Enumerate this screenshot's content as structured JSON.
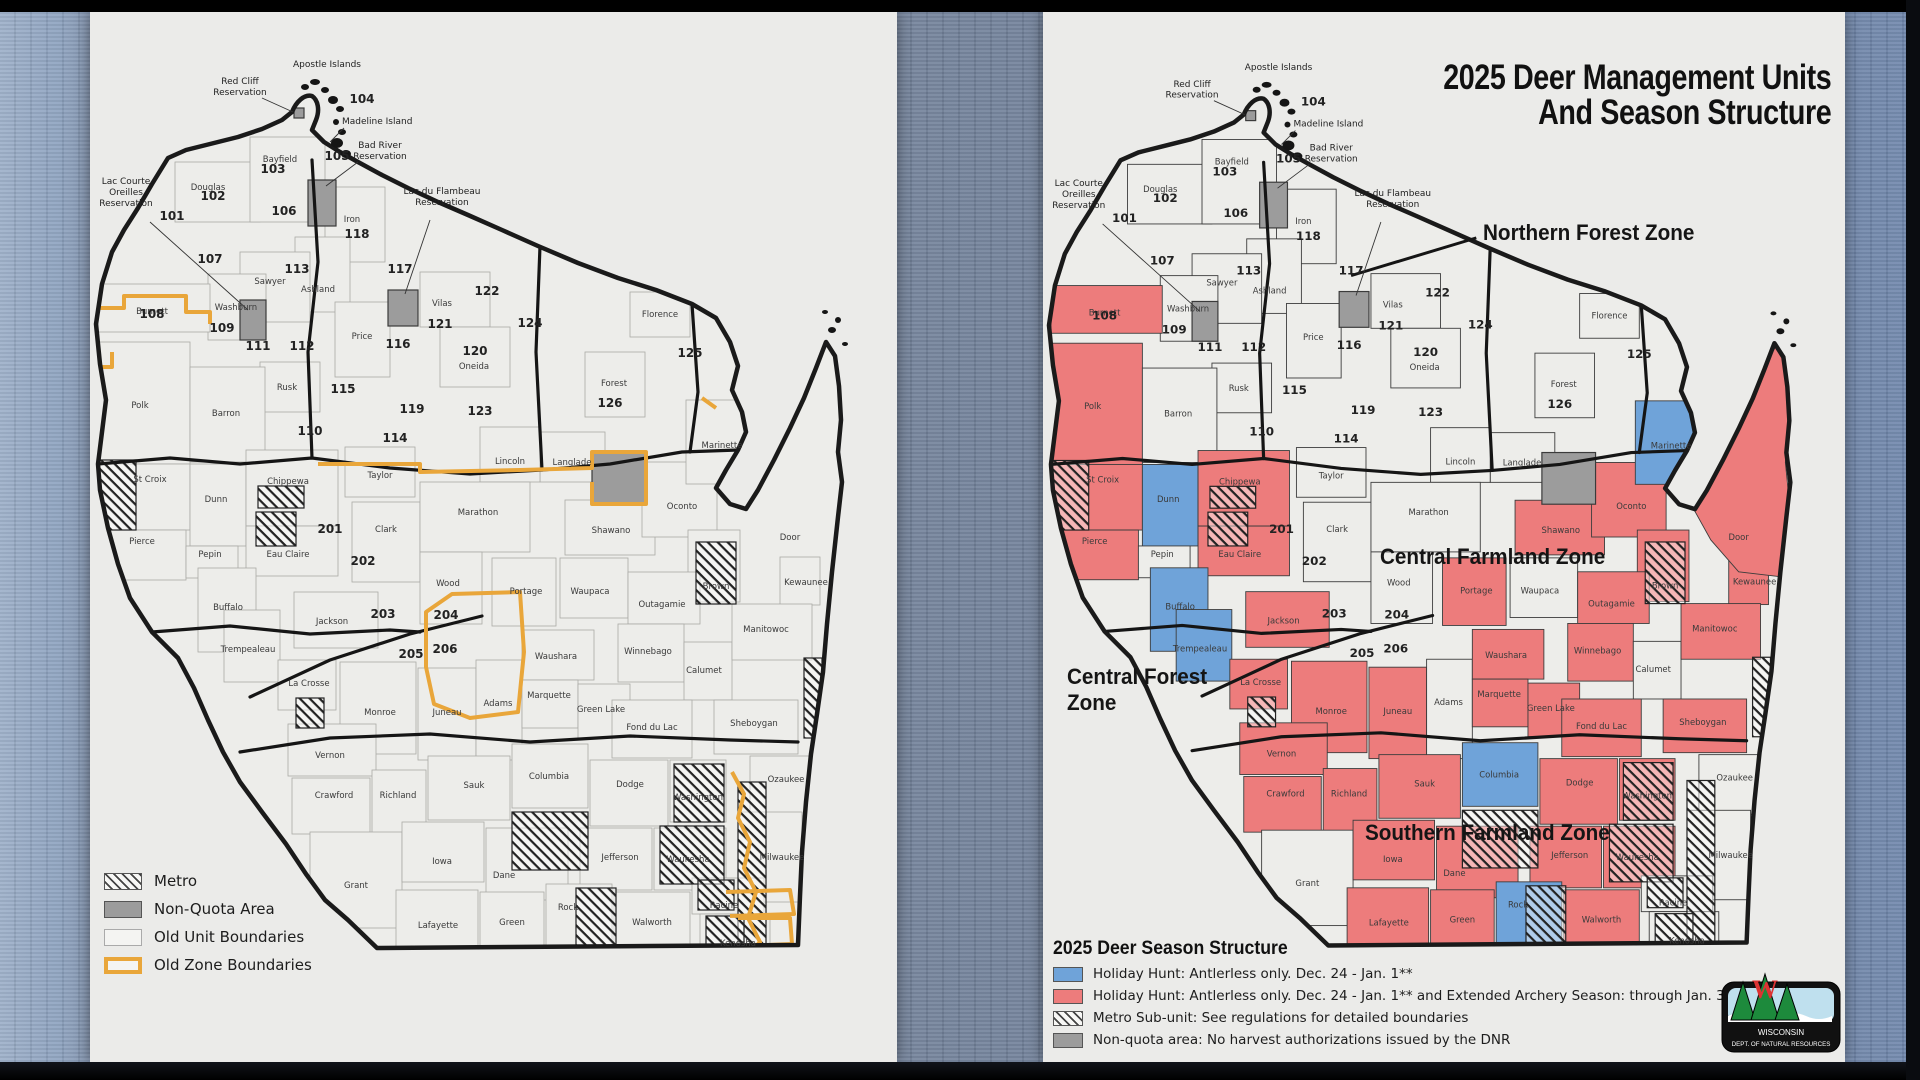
{
  "left_panel": {
    "legend": {
      "items": [
        {
          "swatch": "hatch",
          "label": "Metro"
        },
        {
          "swatch": "gray",
          "label": "Non-Quota Area"
        },
        {
          "swatch": "white",
          "label": "Old Unit Boundaries"
        },
        {
          "swatch": "orange",
          "label": "Old Zone Boundaries"
        }
      ]
    }
  },
  "right_panel": {
    "title_line1": "2025 Deer Management Units",
    "title_line2": "And Season Structure",
    "zone_labels": {
      "northern": "Northern Forest Zone",
      "central_farmland": "Central Farmland Zone",
      "central_forest_1": "Central Forest",
      "central_forest_2": "Zone",
      "southern": "Southern Farmland Zone"
    },
    "legend": {
      "title": "2025 Deer Season Structure",
      "items": [
        {
          "swatch": "blue",
          "label": "Holiday Hunt: Antlerless only. Dec. 24 - Jan. 1**"
        },
        {
          "swatch": "red",
          "label": "Holiday Hunt: Antlerless only. Dec. 24 - Jan. 1** and Extended Archery Season: through Jan. 31, 2026"
        },
        {
          "swatch": "hatch",
          "label": "Metro Sub-unit: See regulations for detailed boundaries"
        },
        {
          "swatch": "gray",
          "label": "Non-quota area: No harvest authorizations issued by the DNR"
        }
      ]
    },
    "logo": {
      "line1": "WISCONSIN",
      "line2": "DEPT. OF NATURAL RESOURCES"
    }
  },
  "map": {
    "colors": {
      "red": "#ed7c7c",
      "blue": "#6fa3d9",
      "gray": "#9c9c9c",
      "paper": "#ededea",
      "orange": "#e9a63a",
      "outline": "#1a1a1a"
    },
    "state_path": "M 78,146 L 96,138 120,132 148,125 172,117 192,108 202,100 C 206,90 214,82 222,84 C 228,88 230,98 226,108 L 222,118 234,130 250,140 268,150 292,163 318,176 348,190 378,203 412,218 448,234 488,251 528,266 566,278 602,292 626,306 L 640,330 648,354 642,378 652,400 656,420 648,438 636,458 626,476 640,492 656,497 L 668,478 684,448 700,416 714,386 726,356 736,330 L 745,344 749,374 751,408 748,440 752,470 748,505 742,560 737,612 733,660 727,702 721,742 716,790 712,840 710,884 708,933 L 560,934 420,935 287,936 L 258,908 235,888 216,862 196,832 172,800 150,770 133,740 118,708 104,676 88,646 62,620 40,586 28,552 18,516 10,478 8,452 12,420 16,388 10,352 6,312 12,272 22,240 34,218 48,196 62,172 78,146 Z",
    "door_polygon": "652,492 668,470 686,440 702,410 716,380 728,350 738,332 746,346 748,380 750,420 747,450 750,480 746,520 742,565 700,560 672,528",
    "islands": [
      [
        215,
        75,
        4,
        3
      ],
      [
        225,
        70,
        5,
        3
      ],
      [
        235,
        78,
        4,
        3
      ],
      [
        243,
        88,
        5,
        4
      ],
      [
        250,
        97,
        4,
        3
      ],
      [
        246,
        110,
        3,
        3
      ],
      [
        252,
        120,
        4,
        3
      ],
      [
        247,
        131,
        6,
        5
      ],
      [
        256,
        142,
        5,
        4
      ],
      [
        742,
        318,
        4,
        3
      ],
      [
        748,
        308,
        3,
        3
      ],
      [
        735,
        300,
        3,
        2
      ],
      [
        755,
        332,
        3,
        2
      ]
    ],
    "thick_lines": [
      "8,452 80,446 150,452 222,446 300,456 380,462 452,458 520,452 592,440 648,438",
      "62,620 140,614 220,622 300,618 330,620",
      "150,740 240,726 340,722 440,730 540,724 640,728 708,730",
      "160,685 240,648 320,622 392,604",
      "222,148 228,250 218,340 222,446",
      "450,234 446,340 452,458",
      "602,292 608,380 600,440"
    ],
    "orange_paths": [
      "M 0,296 L 34,296 L 34,284 L 96,284 L 96,300 L 120,300 L 120,312",
      "M 80,140 L 92,134",
      "M 0,355 L 22,355 L 22,340",
      "M 228,452 L 330,452 L 330,460 L 430,458 L 502,456 L 502,440 L 556,440 L 556,492 L 502,492 L 502,470",
      "M 612,386 L 626,396",
      "M 336,600 L 362,582 L 430,580 L 434,640 L 428,700 L 380,706 L 344,692 L 336,655 Z",
      "M 642,760 L 654,782 L 648,806 L 660,830 L 654,856 L 666,880 L 658,906 L 670,930 L 664,936",
      "M 636,880 L 700,878 L 704,902 L 640,904",
      "M 648,906 L 700,906 L 702,932 L 652,934"
    ],
    "right_leader": "M 310,262 L 436,224",
    "reservations": [
      {
        "name": "Red Cliff Reservation",
        "x": 204,
        "y": 96,
        "w": 10,
        "h": 10
      },
      {
        "name": "Bad River Reservation",
        "x": 218,
        "y": 168,
        "w": 28,
        "h": 46
      },
      {
        "name": "Lac Courte Oreilles Reservation",
        "x": 150,
        "y": 288,
        "w": 26,
        "h": 40
      },
      {
        "name": "Lac du Flambeau Reservation",
        "x": 298,
        "y": 278,
        "w": 30,
        "h": 36
      },
      {
        "name": "Menominee Reservation",
        "x": 502,
        "y": 440,
        "w": 54,
        "h": 52
      }
    ],
    "metro_hatches": [
      [
        8,
        448,
        38,
        70
      ],
      [
        168,
        474,
        46,
        22
      ],
      [
        166,
        500,
        40,
        34
      ],
      [
        206,
        686,
        28,
        30
      ],
      [
        422,
        800,
        76,
        58
      ],
      [
        606,
        530,
        40,
        62
      ],
      [
        584,
        752,
        50,
        58
      ],
      [
        570,
        814,
        64,
        58
      ],
      [
        648,
        770,
        28,
        164
      ],
      [
        608,
        868,
        36,
        30
      ],
      [
        616,
        904,
        38,
        30
      ],
      [
        486,
        876,
        40,
        58
      ],
      [
        714,
        646,
        18,
        80
      ]
    ],
    "counties": [
      [
        "Douglas",
        85,
        150,
        85,
        60,
        118,
        178,
        "w"
      ],
      [
        "Bayfield",
        160,
        125,
        75,
        85,
        190,
        150,
        "w"
      ],
      [
        "Iron",
        235,
        175,
        60,
        75,
        262,
        210,
        "w"
      ],
      [
        "Ashland",
        205,
        225,
        55,
        75,
        228,
        280,
        "w"
      ],
      [
        "Sawyer",
        150,
        240,
        70,
        70,
        180,
        272,
        "w"
      ],
      [
        "Price",
        245,
        290,
        55,
        75,
        272,
        327,
        "w"
      ],
      [
        "Vilas",
        330,
        260,
        70,
        55,
        352,
        294,
        "w"
      ],
      [
        "Oneida",
        350,
        315,
        70,
        60,
        384,
        357,
        "w"
      ],
      [
        "Florence",
        540,
        280,
        60,
        45,
        570,
        305,
        "w"
      ],
      [
        "Forest",
        495,
        340,
        60,
        65,
        524,
        374,
        "w"
      ],
      [
        "Langlade",
        450,
        420,
        65,
        50,
        482,
        453,
        "w"
      ],
      [
        "Lincoln",
        390,
        415,
        60,
        55,
        420,
        452,
        "w"
      ],
      [
        "Taylor",
        255,
        435,
        70,
        50,
        290,
        466,
        "w"
      ],
      [
        "Rusk",
        170,
        350,
        60,
        50,
        197,
        378,
        "w"
      ],
      [
        "Washburn",
        118,
        262,
        58,
        66,
        146,
        298,
        "w"
      ],
      [
        "Burnett",
        8,
        272,
        112,
        48,
        62,
        302,
        "r"
      ],
      [
        "Polk",
        8,
        330,
        92,
        122,
        50,
        396,
        "r"
      ],
      [
        "Barron",
        100,
        355,
        75,
        95,
        136,
        404,
        "w"
      ],
      [
        "St Croix",
        8,
        452,
        92,
        66,
        60,
        470,
        "r"
      ],
      [
        "Dunn",
        100,
        452,
        56,
        82,
        126,
        490,
        "b"
      ],
      [
        "Chippewa",
        156,
        438,
        92,
        76,
        198,
        472,
        "r"
      ],
      [
        "Pierce",
        8,
        518,
        88,
        50,
        52,
        532,
        "r"
      ],
      [
        "Pepin",
        96,
        534,
        52,
        32,
        120,
        545,
        "w"
      ],
      [
        "Eau Claire",
        156,
        514,
        92,
        50,
        198,
        545,
        "r"
      ],
      [
        "Clark",
        262,
        490,
        68,
        80,
        296,
        520,
        "w"
      ],
      [
        "Marathon",
        330,
        470,
        110,
        70,
        388,
        503,
        "w"
      ],
      [
        "Shawano",
        475,
        488,
        90,
        55,
        521,
        521,
        "r"
      ],
      [
        "Oconto",
        552,
        450,
        75,
        75,
        592,
        497,
        "r"
      ],
      [
        "Kewaunee",
        690,
        545,
        40,
        48,
        716,
        573,
        "r"
      ],
      [
        "Brown",
        598,
        518,
        52,
        72,
        626,
        577,
        "r"
      ],
      [
        "Marinette",
        596,
        388,
        74,
        84,
        632,
        436,
        "b"
      ],
      [
        "Buffalo",
        108,
        556,
        58,
        84,
        138,
        598,
        "b"
      ],
      [
        "Trempealeau",
        134,
        598,
        56,
        72,
        158,
        640,
        "b"
      ],
      [
        "Jackson",
        204,
        580,
        84,
        56,
        242,
        612,
        "r"
      ],
      [
        "Wood",
        330,
        540,
        62,
        72,
        358,
        574,
        "w"
      ],
      [
        "Portage",
        402,
        546,
        64,
        68,
        436,
        582,
        "r"
      ],
      [
        "Waupaca",
        470,
        546,
        68,
        60,
        500,
        582,
        "w"
      ],
      [
        "Outagamie",
        538,
        560,
        72,
        52,
        572,
        595,
        "r"
      ],
      [
        "La Crosse",
        188,
        648,
        58,
        50,
        219,
        674,
        "r"
      ],
      [
        "Monroe",
        250,
        650,
        76,
        92,
        290,
        703,
        "r"
      ],
      [
        "Juneau",
        328,
        656,
        58,
        92,
        357,
        703,
        "r"
      ],
      [
        "Adams",
        386,
        648,
        46,
        100,
        408,
        694,
        "w"
      ],
      [
        "Waushara",
        432,
        618,
        72,
        50,
        466,
        647,
        "r"
      ],
      [
        "Marquette",
        432,
        668,
        56,
        48,
        459,
        686,
        "r"
      ],
      [
        "Green Lake",
        488,
        672,
        52,
        54,
        511,
        700,
        "r"
      ],
      [
        "Winnebago",
        528,
        612,
        66,
        58,
        558,
        642,
        "r"
      ],
      [
        "Calumet",
        594,
        630,
        48,
        58,
        614,
        661,
        "w"
      ],
      [
        "Fond du Lac",
        522,
        688,
        80,
        58,
        562,
        718,
        "r"
      ],
      [
        "Manitowoc",
        642,
        592,
        80,
        56,
        676,
        620,
        "r"
      ],
      [
        "Sheboygan",
        624,
        688,
        84,
        54,
        664,
        714,
        "r"
      ],
      [
        "Vernon",
        198,
        712,
        88,
        52,
        240,
        746,
        "r"
      ],
      [
        "Crawford",
        202,
        766,
        78,
        56,
        244,
        786,
        "r"
      ],
      [
        "Richland",
        282,
        758,
        54,
        72,
        308,
        786,
        "r"
      ],
      [
        "Sauk",
        338,
        744,
        82,
        64,
        384,
        776,
        "r"
      ],
      [
        "Columbia",
        422,
        732,
        76,
        64,
        459,
        767,
        "b"
      ],
      [
        "Dodge",
        500,
        748,
        78,
        66,
        540,
        775,
        "r"
      ],
      [
        "Washington",
        580,
        748,
        56,
        62,
        608,
        788,
        "r"
      ],
      [
        "Ozaukee",
        660,
        744,
        60,
        60,
        696,
        770,
        "w"
      ],
      [
        "Grant",
        220,
        820,
        92,
        96,
        266,
        876,
        "w"
      ],
      [
        "Iowa",
        312,
        810,
        82,
        60,
        352,
        852,
        "r"
      ],
      [
        "Dane",
        396,
        816,
        82,
        72,
        414,
        866,
        "r"
      ],
      [
        "Jefferson",
        490,
        816,
        72,
        62,
        530,
        848,
        "r"
      ],
      [
        "Waukesha",
        564,
        816,
        72,
        62,
        598,
        850,
        "r"
      ],
      [
        "Milwaukee",
        648,
        800,
        64,
        90,
        692,
        848,
        "w"
      ],
      [
        "Lafayette",
        306,
        878,
        82,
        58,
        348,
        916,
        "r"
      ],
      [
        "Green",
        390,
        880,
        64,
        56,
        422,
        913,
        "r"
      ],
      [
        "Rock",
        456,
        872,
        66,
        64,
        478,
        898,
        "b"
      ],
      [
        "Walworth",
        524,
        880,
        76,
        56,
        562,
        913,
        "r"
      ],
      [
        "Racine",
        602,
        866,
        72,
        36,
        634,
        896,
        "w"
      ],
      [
        "Kenosha",
        610,
        902,
        70,
        34,
        648,
        934,
        "w"
      ],
      [
        "Door",
        0,
        0,
        0,
        0,
        700,
        528,
        "x"
      ]
    ],
    "units": [
      [
        101,
        82,
        208
      ],
      [
        102,
        123,
        188
      ],
      [
        103,
        183,
        161
      ],
      [
        104,
        272,
        91
      ],
      [
        105,
        247,
        148
      ],
      [
        106,
        194,
        203
      ],
      [
        107,
        120,
        251
      ],
      [
        108,
        62,
        306
      ],
      [
        109,
        132,
        320
      ],
      [
        110,
        220,
        423
      ],
      [
        111,
        168,
        338
      ],
      [
        112,
        212,
        338
      ],
      [
        113,
        207,
        261
      ],
      [
        114,
        305,
        430
      ],
      [
        115,
        253,
        381
      ],
      [
        116,
        308,
        336
      ],
      [
        117,
        310,
        261
      ],
      [
        118,
        267,
        226
      ],
      [
        119,
        322,
        401
      ],
      [
        120,
        385,
        343
      ],
      [
        121,
        350,
        316
      ],
      [
        122,
        397,
        283
      ],
      [
        123,
        390,
        403
      ],
      [
        124,
        440,
        315
      ],
      [
        125,
        600,
        345
      ],
      [
        126,
        520,
        395
      ],
      [
        201,
        240,
        521
      ],
      [
        202,
        273,
        553
      ],
      [
        203,
        293,
        606
      ],
      [
        204,
        356,
        607
      ],
      [
        205,
        321,
        646
      ],
      [
        206,
        355,
        641
      ]
    ],
    "annotations": [
      {
        "lines": [
          "Apostle Islands"
        ],
        "x": 237,
        "y": 55,
        "anchor": "middle",
        "leader": null
      },
      {
        "lines": [
          "Red Cliff",
          "Reservation"
        ],
        "x": 150,
        "y": 72,
        "anchor": "middle",
        "leader": [
          172,
          86,
          203,
          100
        ]
      },
      {
        "lines": [
          "Madeline Island"
        ],
        "x": 252,
        "y": 112,
        "anchor": "start",
        "leader": [
          254,
          116,
          240,
          130
        ]
      },
      {
        "lines": [
          "Bad River",
          "Reservation"
        ],
        "x": 290,
        "y": 136,
        "anchor": "middle",
        "leader": [
          268,
          150,
          236,
          174
        ]
      },
      {
        "lines": [
          "Lac Courte",
          "Oreilles",
          "Reservation"
        ],
        "x": 36,
        "y": 172,
        "anchor": "middle",
        "leader": [
          60,
          210,
          158,
          298
        ]
      },
      {
        "lines": [
          "Lac du Flambeau",
          "Reservation"
        ],
        "x": 352,
        "y": 182,
        "anchor": "middle",
        "leader": [
          340,
          208,
          315,
          282
        ]
      }
    ]
  }
}
